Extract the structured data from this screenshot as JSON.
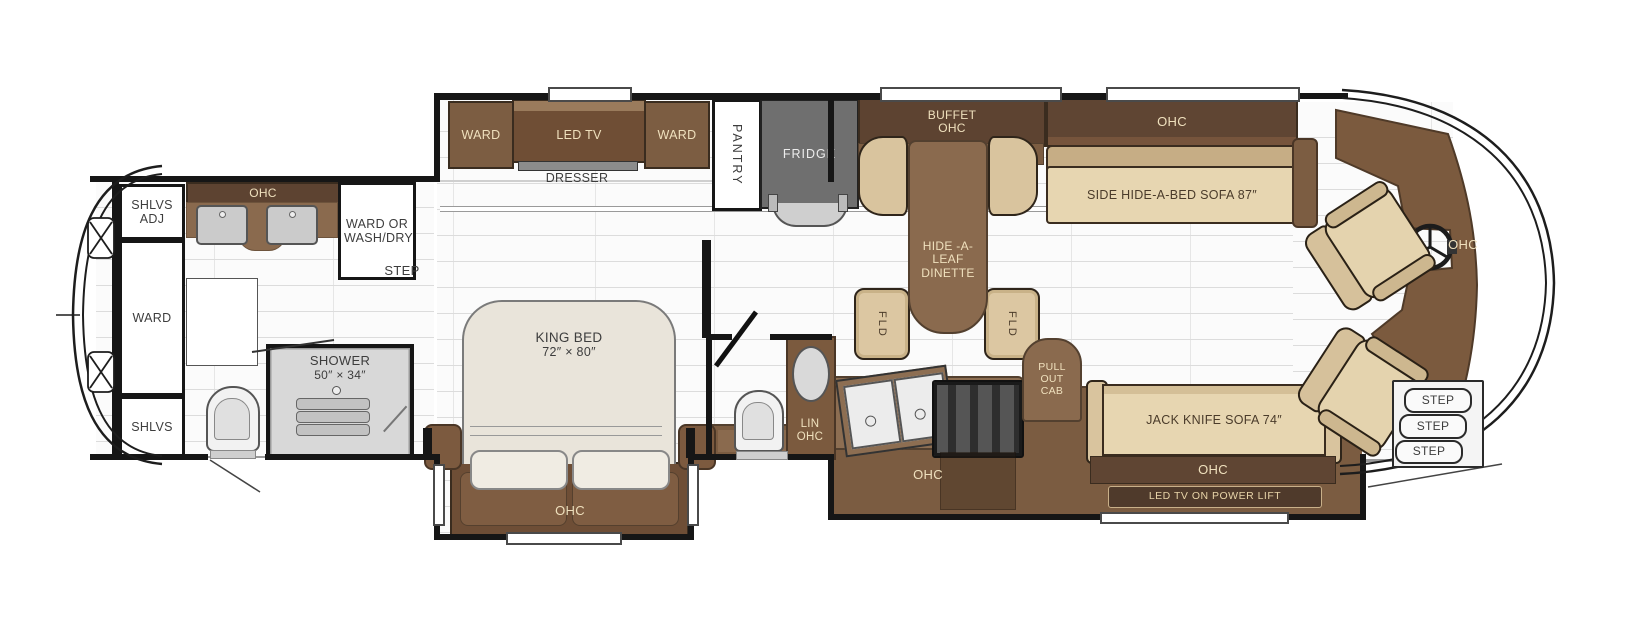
{
  "plan_title": "Class A motorhome floor plan",
  "rear_bath": {
    "shlvs_adj": "SHLVS ADJ",
    "ohc": "OHC",
    "ward_or_washdry": "WARD OR WASH/DRY",
    "ward": "WARD",
    "shlvs": "SHLVS",
    "step": "STEP",
    "shower": "SHOWER",
    "shower_size": "50″ × 34″"
  },
  "bedroom": {
    "ward_left": "WARD",
    "led_tv": "LED TV",
    "ward_right": "WARD",
    "dresser": "DRESSER",
    "king_bed": "KING BED",
    "king_bed_size": "72″ × 80″",
    "foot_ohc": "OHC"
  },
  "hall": {
    "pantry": "PANTRY",
    "fridge": "FRIDGE"
  },
  "mid_bath": {
    "lin_ohc": "LIN OHC"
  },
  "dinette": {
    "buffet_ohc": "BUFFET OHC",
    "table": "HIDE -A- LEAF DINETTE",
    "fld": "FLD"
  },
  "living": {
    "sofa_ohc": "OHC",
    "side_sofa": "SIDE HIDE-A-BED SOFA 87″"
  },
  "kitchen": {
    "ohc": "OHC",
    "pull_out_cab": "PULL OUT CAB",
    "jack_sofa": "JACK KNIFE SOFA 74″",
    "jk_ohc": "OHC",
    "tv_lift": "LED TV ON POWER LIFT"
  },
  "cockpit": {
    "dash_ohc": "OHC",
    "steps": [
      "STEP",
      "STEP",
      "STEP"
    ]
  },
  "colors": {
    "cabinet_dark": "#5d4331",
    "cabinet_mid": "#7c5d42",
    "counter_brown": "#8a6a4e",
    "upholstery_tan": "#e7d6b1",
    "fridge_gray": "#6f6f6f",
    "wall_black": "#161616"
  }
}
